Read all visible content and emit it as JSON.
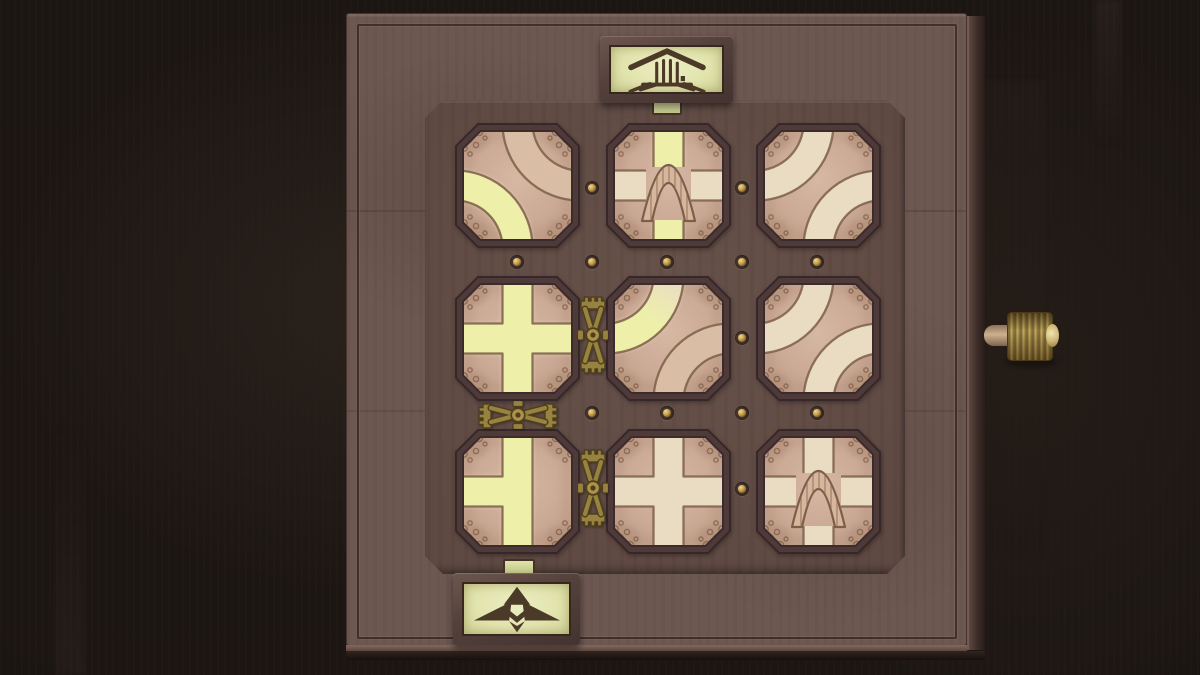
{
  "scene": {
    "type": "puzzle-game-board",
    "description": "Top-down wooden puzzle box with a 3x3 grid of octagonal rotatable trail tiles; a lit trail runs from the hut entrance at top to the winged-arrow exit at bottom; brass gear links join some tiles and a knurled brass knob protrudes from the right edge"
  },
  "board": {
    "rows": 3,
    "cols": 3,
    "tiles": [
      {
        "id": "r0c0",
        "row": 0,
        "col": 0,
        "bridge": false,
        "paths": [
          {
            "shape": "curve",
            "connects": [
              "top",
              "right"
            ],
            "state": "dim"
          },
          {
            "shape": "curve",
            "connects": [
              "left",
              "bottom"
            ],
            "state": "lit"
          }
        ]
      },
      {
        "id": "r0c1",
        "row": 0,
        "col": 1,
        "bridge": true,
        "paths": [
          {
            "shape": "straight",
            "connects": [
              "left",
              "right"
            ],
            "state": "unlit"
          },
          {
            "shape": "straight",
            "connects": [
              "top",
              "bottom"
            ],
            "state": "lit"
          }
        ]
      },
      {
        "id": "r0c2",
        "row": 0,
        "col": 2,
        "bridge": false,
        "paths": [
          {
            "shape": "curve",
            "connects": [
              "top",
              "left"
            ],
            "state": "unlit"
          },
          {
            "shape": "curve",
            "connects": [
              "bottom",
              "right"
            ],
            "state": "unlit"
          }
        ]
      },
      {
        "id": "r1c0",
        "row": 1,
        "col": 0,
        "bridge": false,
        "paths": [
          {
            "shape": "cross",
            "connects": [
              "top",
              "right",
              "bottom",
              "left"
            ],
            "state": "lit"
          }
        ]
      },
      {
        "id": "r1c1",
        "row": 1,
        "col": 1,
        "bridge": false,
        "paths": [
          {
            "shape": "curve",
            "connects": [
              "left",
              "top"
            ],
            "state": "partial"
          },
          {
            "shape": "curve",
            "connects": [
              "bottom",
              "right"
            ],
            "state": "dim"
          }
        ]
      },
      {
        "id": "r1c2",
        "row": 1,
        "col": 2,
        "bridge": false,
        "paths": [
          {
            "shape": "curve",
            "connects": [
              "top",
              "left"
            ],
            "state": "unlit"
          },
          {
            "shape": "curve",
            "connects": [
              "bottom",
              "right"
            ],
            "state": "unlit"
          }
        ]
      },
      {
        "id": "r2c0",
        "row": 2,
        "col": 0,
        "bridge": false,
        "paths": [
          {
            "shape": "tee",
            "connects": [
              "top",
              "bottom",
              "left"
            ],
            "state": "lit"
          }
        ]
      },
      {
        "id": "r2c1",
        "row": 2,
        "col": 1,
        "bridge": false,
        "paths": [
          {
            "shape": "cross",
            "connects": [
              "top",
              "right",
              "bottom",
              "left"
            ],
            "state": "unlit"
          }
        ]
      },
      {
        "id": "r2c2",
        "row": 2,
        "col": 2,
        "bridge": true,
        "paths": [
          {
            "shape": "straight",
            "connects": [
              "left",
              "right"
            ],
            "state": "unlit"
          },
          {
            "shape": "straight",
            "connects": [
              "top",
              "bottom"
            ],
            "state": "unlit"
          }
        ]
      }
    ],
    "links": [
      {
        "id": "link-r1c0-r1c1",
        "between": [
          "r1c0",
          "r1c1"
        ],
        "orientation": "vertical"
      },
      {
        "id": "link-r1c0-r2c0",
        "between": [
          "r1c0",
          "r2c0"
        ],
        "orientation": "horizontal"
      },
      {
        "id": "link-r2c0-r2c1",
        "between": [
          "r2c0",
          "r2c1"
        ],
        "orientation": "vertical"
      }
    ],
    "rivets": [
      [
        517,
        262
      ],
      [
        592,
        262
      ],
      [
        667,
        262
      ],
      [
        742,
        262
      ],
      [
        817,
        262
      ],
      [
        592,
        413
      ],
      [
        667,
        413
      ],
      [
        742,
        413
      ],
      [
        817,
        413
      ],
      [
        592,
        188
      ],
      [
        742,
        188
      ],
      [
        742,
        338
      ],
      [
        742,
        489
      ]
    ]
  },
  "markers": {
    "entrance": {
      "side": "top",
      "icon": "stilt-hut-icon",
      "lit": true
    },
    "exit": {
      "side": "bottom",
      "icon": "winged-up-arrow-icon",
      "lit": true
    }
  },
  "knob": {
    "side": "right",
    "style": "knurled-brass"
  },
  "palette": {
    "background": "#1c1613",
    "board": "#6d5751",
    "panel": "#5f4a43",
    "tile_frame": "#4e3a38",
    "tile_frame_edge": "#36282a",
    "tile_seam": "#3b2c2b",
    "tile_face": "#cbaa96",
    "face_light": "#d6b8a3",
    "face_dark": "#bb9983",
    "mottle": "#9f7963",
    "path_lit": "#eef0a9",
    "path_lit_glow": "#f8f9d0",
    "path_unlit": "#e9dcc2",
    "path_dim": "#d9bda4",
    "path_outline": "#7c5e49",
    "bridge": "#d6b79e",
    "bridge_plank": "#8a6751",
    "doodle": "#7b5a45",
    "brass": "#97823f",
    "brass_hub": "#ab9149",
    "brass_dark": "#4e3f1d",
    "plaque_face": "#e2e4ae",
    "plaque_frame": "#57423d",
    "icon_color": "#4b3a28",
    "tab": "#d3d79c",
    "knob_gold": "#b49a52",
    "rivet_gold": "#c59d4a"
  }
}
